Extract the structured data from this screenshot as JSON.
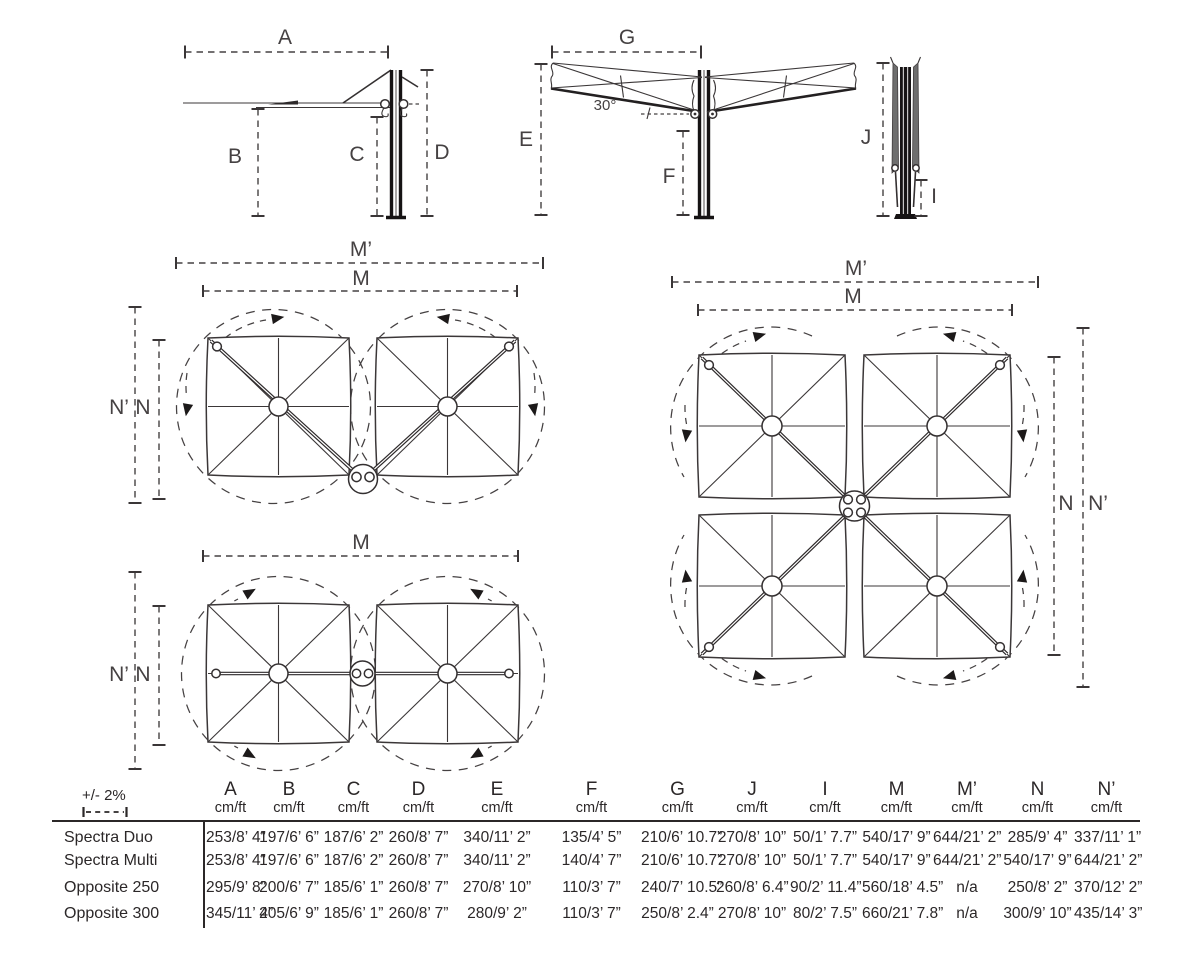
{
  "diagrams": {
    "side_open": {
      "labels": {
        "a": "A",
        "b": "B",
        "c": "C",
        "d": "D"
      }
    },
    "side_tilted": {
      "labels": {
        "g": "G",
        "e": "E",
        "f": "F",
        "angle": "30°"
      }
    },
    "side_closed": {
      "labels": {
        "j": "J",
        "i": "I"
      }
    },
    "plan_duo_corner": {
      "labels": {
        "m_outer": "M’",
        "m": "M",
        "n_outer": "N’",
        "n": "N"
      }
    },
    "plan_duo_side": {
      "labels": {
        "m": "M",
        "n_outer": "N’",
        "n": "N"
      }
    },
    "plan_quad": {
      "labels": {
        "m_outer": "M’",
        "m": "M",
        "n": "N",
        "n_outer": "N’"
      }
    }
  },
  "table": {
    "tolerance": "+/- 2%",
    "columns": [
      {
        "letter": "A",
        "unit": "cm/ft"
      },
      {
        "letter": "B",
        "unit": "cm/ft"
      },
      {
        "letter": "C",
        "unit": "cm/ft"
      },
      {
        "letter": "D",
        "unit": "cm/ft"
      },
      {
        "letter": "E",
        "unit": "cm/ft"
      },
      {
        "letter": "F",
        "unit": "cm/ft"
      },
      {
        "letter": "G",
        "unit": "cm/ft"
      },
      {
        "letter": "J",
        "unit": "cm/ft"
      },
      {
        "letter": "I",
        "unit": "cm/ft"
      },
      {
        "letter": "M",
        "unit": "cm/ft"
      },
      {
        "letter": "M’",
        "unit": "cm/ft"
      },
      {
        "letter": "N",
        "unit": "cm/ft"
      },
      {
        "letter": "N’",
        "unit": "cm/ft"
      }
    ],
    "rows": [
      {
        "name": "Spectra Duo",
        "values": [
          "253/8’ 4”",
          "197/6’ 6”",
          "187/6’ 2”",
          "260/8’ 7”",
          "340/11’ 2”",
          "135/4’ 5”",
          "210/6’ 10.7”",
          "270/8’ 10”",
          "50/1’ 7.7”",
          "540/17’ 9”",
          "644/21’ 2”",
          "285/9’ 4”",
          "337/11’ 1”"
        ]
      },
      {
        "name": "Spectra Multi",
        "values": [
          "253/8’ 4”",
          "197/6’ 6”",
          "187/6’ 2”",
          "260/8’ 7”",
          "340/11’ 2”",
          "140/4’ 7”",
          "210/6’ 10.7”",
          "270/8’ 10”",
          "50/1’ 7.7”",
          "540/17’ 9”",
          "644/21’ 2”",
          "540/17’ 9”",
          "644/21’ 2”"
        ]
      },
      {
        "name": "Opposite 250",
        "values": [
          "295/9’ 8”",
          "200/6’ 7”",
          "185/6’ 1”",
          "260/8’ 7”",
          "270/8’ 10”",
          "110/3’ 7”",
          "240/7’ 10.5”",
          "260/8’ 6.4”",
          "90/2’ 11.4”",
          "560/18’ 4.5”",
          "n/a",
          "250/8’ 2”",
          "370/12’ 2”"
        ]
      },
      {
        "name": "Opposite 300",
        "values": [
          "345/11’ 4”",
          "205/6’ 9”",
          "185/6’ 1”",
          "260/8’ 7”",
          "280/9’ 2”",
          "110/3’ 7”",
          "250/8’ 2.4”",
          "270/8’ 10”",
          "80/2’ 7.5”",
          "660/21’ 7.8”",
          "n/a",
          "300/9’ 10”",
          "435/14’ 3”"
        ]
      }
    ]
  }
}
